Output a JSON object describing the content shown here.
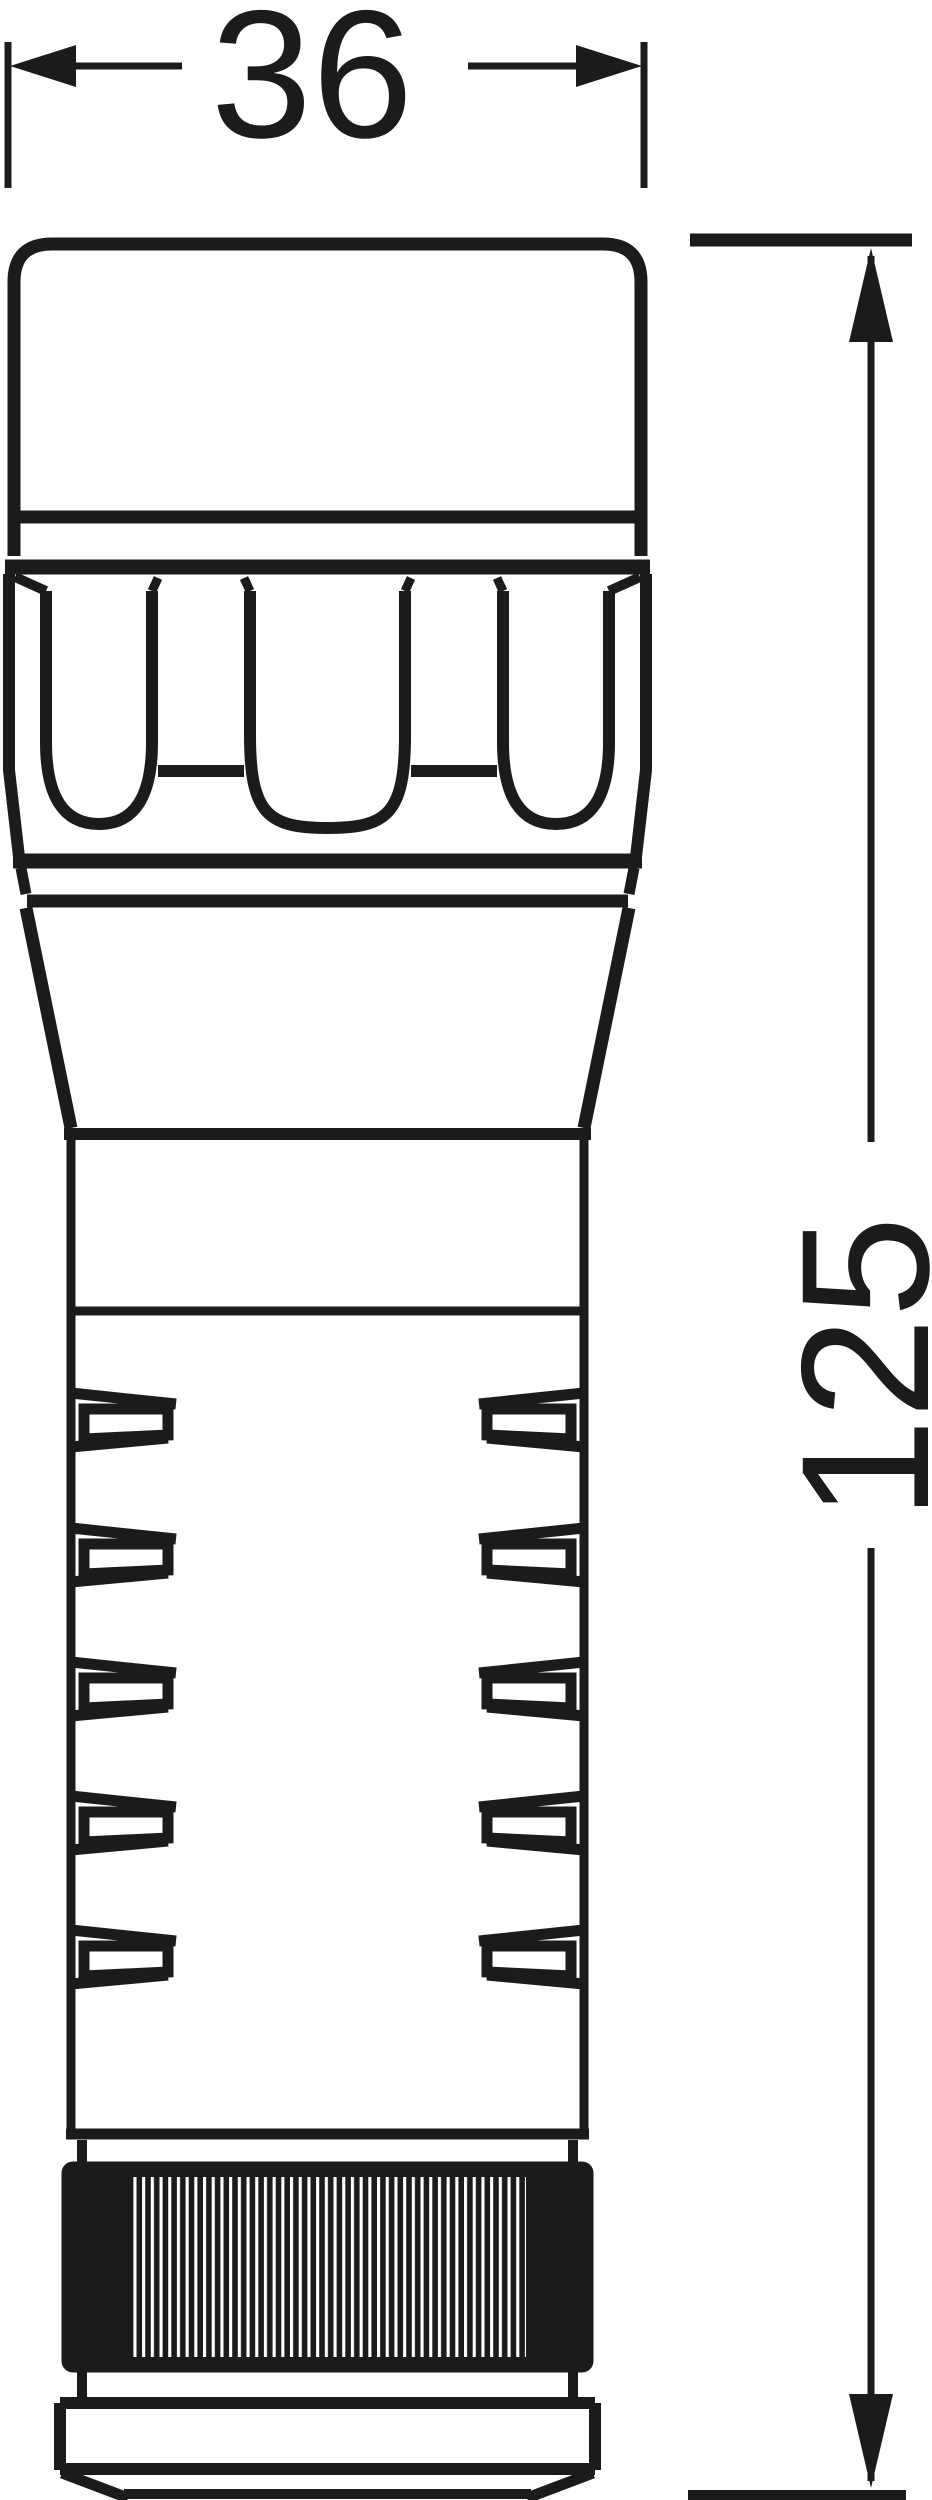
{
  "page": {
    "background_color": "#ffffff"
  },
  "drawing": {
    "object": "flashlight-side-profile-technical-drawing",
    "line_color": "#1d1b1a",
    "dimensions": {
      "width": {
        "value": "36"
      },
      "height": {
        "value": "125"
      }
    }
  }
}
